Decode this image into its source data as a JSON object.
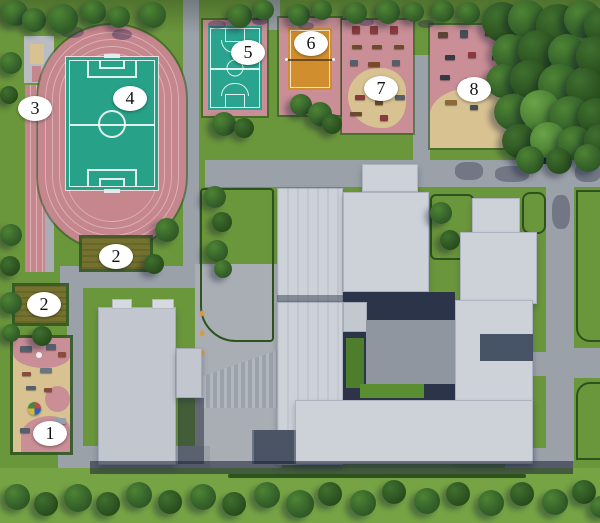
{
  "labels": {
    "area1": "1",
    "area2a": "2",
    "area2b": "2",
    "area3": "3",
    "area4": "4",
    "area5": "5",
    "area6": "6",
    "area7": "7",
    "area8": "8"
  },
  "areas": [
    {
      "number": "1",
      "name": "children-playground"
    },
    {
      "number": "2",
      "name": "garden-plot-upper"
    },
    {
      "number": "2",
      "name": "garden-plot-lower"
    },
    {
      "number": "3",
      "name": "running-track"
    },
    {
      "number": "4",
      "name": "football-field"
    },
    {
      "number": "5",
      "name": "basketball-court"
    },
    {
      "number": "6",
      "name": "volleyball-court"
    },
    {
      "number": "7",
      "name": "sports-playground"
    },
    {
      "number": "8",
      "name": "sports-playground"
    }
  ],
  "colors": {
    "grass": "#6b973c",
    "grass_light": "#76a445",
    "road_gray": "#9ba1a9",
    "path_light": "#a9aeb4",
    "track_pink": "#c5868d",
    "lane_line": "#dcb0b5",
    "field_teal": "#28a189",
    "court_teal": "#2aa38f",
    "volleyball_orange": "#d18e2e",
    "playground_pink": "#c98e96",
    "sand_beige": "#d8c292",
    "plot_olive": "#74722e",
    "hedge_green": "#2d521d",
    "forest_green": "#2f5724",
    "building_gray": "#cdd1d8",
    "building_gray_dark": "#c2c7cf",
    "shadow_navy": "#2b3448",
    "label_bg": "#ffffff",
    "label_text": "#141414",
    "lamp_amber": "#d99a3e"
  }
}
